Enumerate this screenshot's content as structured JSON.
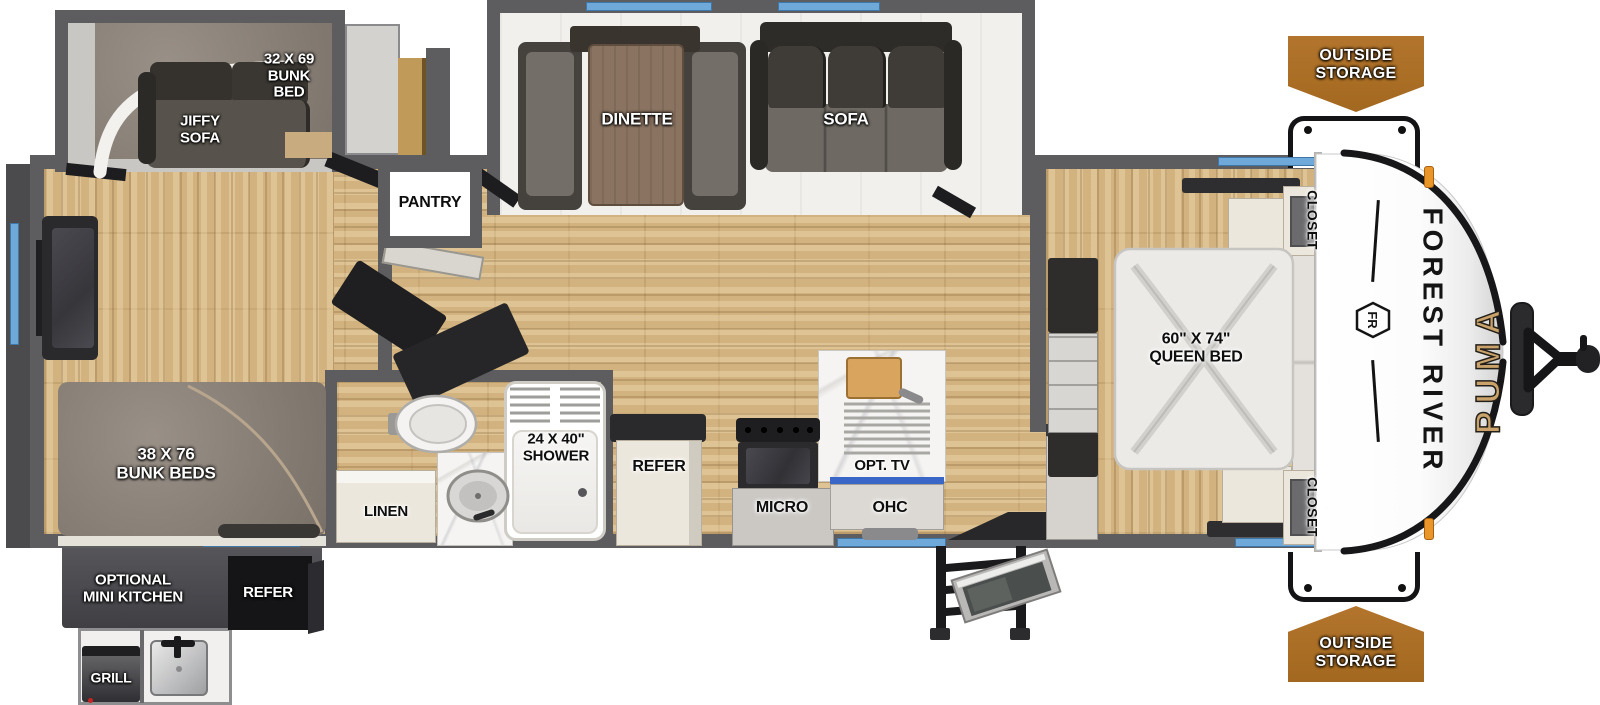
{
  "labels": {
    "bunk_bed_32": "32 X 69\nBUNK\nBED",
    "jiffy_sofa": "JIFFY\nSOFA",
    "bunk_beds_38": "38 X 76\nBUNK BEDS",
    "pantry": "PANTRY",
    "dinette": "DINETTE",
    "sofa": "SOFA",
    "linen": "LINEN",
    "shower": "24 X 40\"\nSHOWER",
    "refer": "REFER",
    "micro": "MICRO",
    "opt_tv": "OPT. TV",
    "ohc": "OHC",
    "queen_bed": "60\" X 74\"\nQUEEN BED",
    "closet_top": "CLOSET",
    "closet_bottom": "CLOSET"
  },
  "exterior": {
    "outside_storage_top": "OUTSIDE\nSTORAGE",
    "outside_storage_bottom": "OUTSIDE\nSTORAGE",
    "optional_mini_kitchen": "OPTIONAL\nMINI KITCHEN",
    "refer": "REFER",
    "grill": "GRILL",
    "brand": "FOREST RIVER",
    "brand_logo": "FR",
    "model": "PUMA"
  },
  "colors": {
    "badge_orange": "#b3752d",
    "window_blue": "#6ea9da",
    "wall_gray": "#5d5d60",
    "wood_floor": "#d2b27e",
    "brand_gold": "#c9a36b",
    "fabric_gray": "#8d8379",
    "marker_orange": "#e8952a"
  }
}
